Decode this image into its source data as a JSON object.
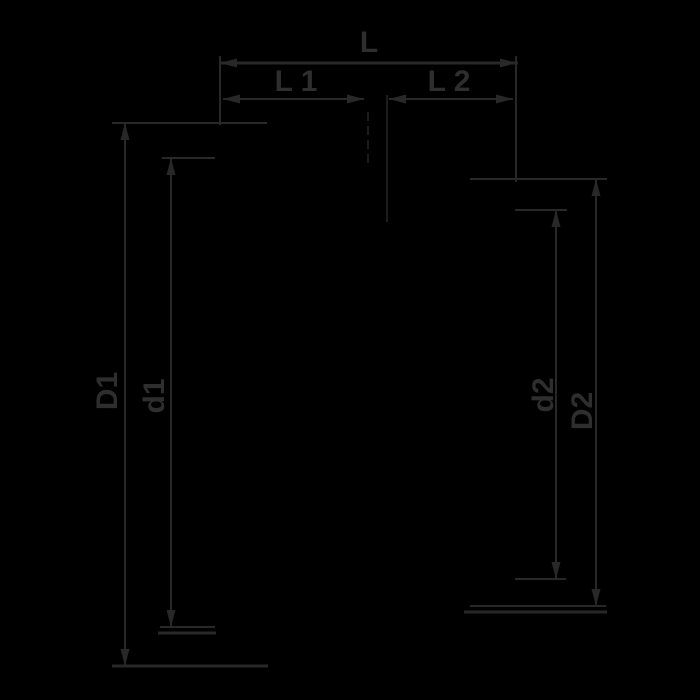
{
  "colors": {
    "background": "#000000",
    "line": "#282828",
    "line_faint": "#1c1c1c",
    "label": "#2e2e2e"
  },
  "diagram": {
    "labels": {
      "L": "L",
      "L1": "L 1",
      "L2": "L 2",
      "D1": "D1",
      "d1": "d1",
      "d2": "d2",
      "D2": "D2"
    }
  }
}
